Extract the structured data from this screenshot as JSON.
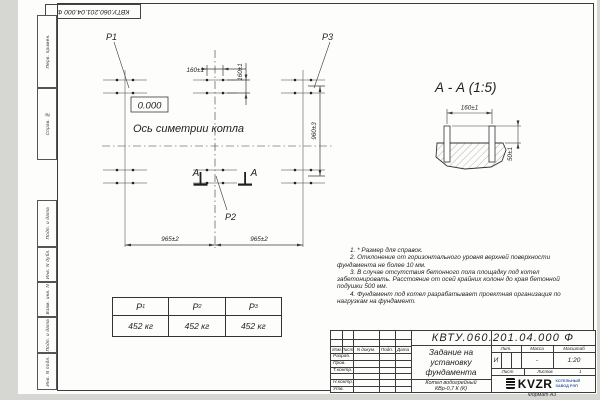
{
  "colors": {
    "line": "#3a3a3a",
    "logo_caption": "#3a5fa8"
  },
  "top_stamp": {
    "text": "КВТУ.060.201.04.000  Ф"
  },
  "margin_labels": {
    "first_use": "Перв. примен.",
    "ref_number": "Справ. №",
    "sign_date_1": "Подп. и дата",
    "inv_dupl": "Инв. N дубл.",
    "repl_inv": "Взам. инв. N",
    "sign_date_2": "Подп. и дата",
    "inv_orig": "Инв. N подл."
  },
  "plan": {
    "label_p1": "Р1",
    "label_p2": "Р2",
    "label_p3": "Р3",
    "dim_bolt_h": "160±1",
    "dim_bolt_v": "160±1",
    "dim_row": "960±3",
    "dim_span_left": "965±2",
    "dim_span_right": "965±2",
    "level_mark": "0.000",
    "axis_label": "Ось симетрии котла",
    "section_letter_left": "А",
    "section_letter_right": "А"
  },
  "section_view": {
    "title": "А - А (1:5)",
    "dim_width": "160±1",
    "dim_height": "50±1"
  },
  "load_table": {
    "columns": [
      {
        "symbol": "Р",
        "sub": "1",
        "value": "452 кг"
      },
      {
        "symbol": "Р",
        "sub": "2",
        "value": "452 кг"
      },
      {
        "symbol": "Р",
        "sub": "3",
        "value": "452 кг"
      }
    ]
  },
  "notes": [
    "1. * Размер для справок.",
    "2. Отклонение от горизонтального уровня верхней поверхности фундамента не более 10 мм.",
    "3. В случае отсутствия бетонного пола площадку под котел забетонировать. Расстояние от осей крайних колонн до края бетонной подушки 500 мм.",
    "4. Фундамент под котел разрабатывает проектная организация по нагрузкам на фундамент."
  ],
  "title_block": {
    "doc_number": "КВТУ.060.201.04.000  Ф",
    "rev_headers": [
      "Изм",
      "Лист",
      "N докум.",
      "Подп.",
      "Дата"
    ],
    "sign_rows": [
      "Разраб.",
      "Пров.",
      "Т.контр.",
      "Н.контр.",
      "Утв."
    ],
    "title_line1": "Задание на",
    "title_line2": "установку",
    "title_line3": "фундамента",
    "product_line1": "Котел водогрейный",
    "product_line2": "КВр-0,7 К (К)",
    "lit_header": "Лит.",
    "mass_header": "Масса",
    "scale_header": "Масштаб",
    "lit_value": "И",
    "mass_value": "-",
    "scale_value": "1:20",
    "sheet_label": "Лист",
    "sheets_label": "Листов",
    "sheets_value": "1",
    "logo_text": "KVZR",
    "logo_caption_line1": "КОТЕЛЬНЫЙ",
    "logo_caption_line2": "ЗАВОД РЭП",
    "format_label": "Формат А3"
  }
}
